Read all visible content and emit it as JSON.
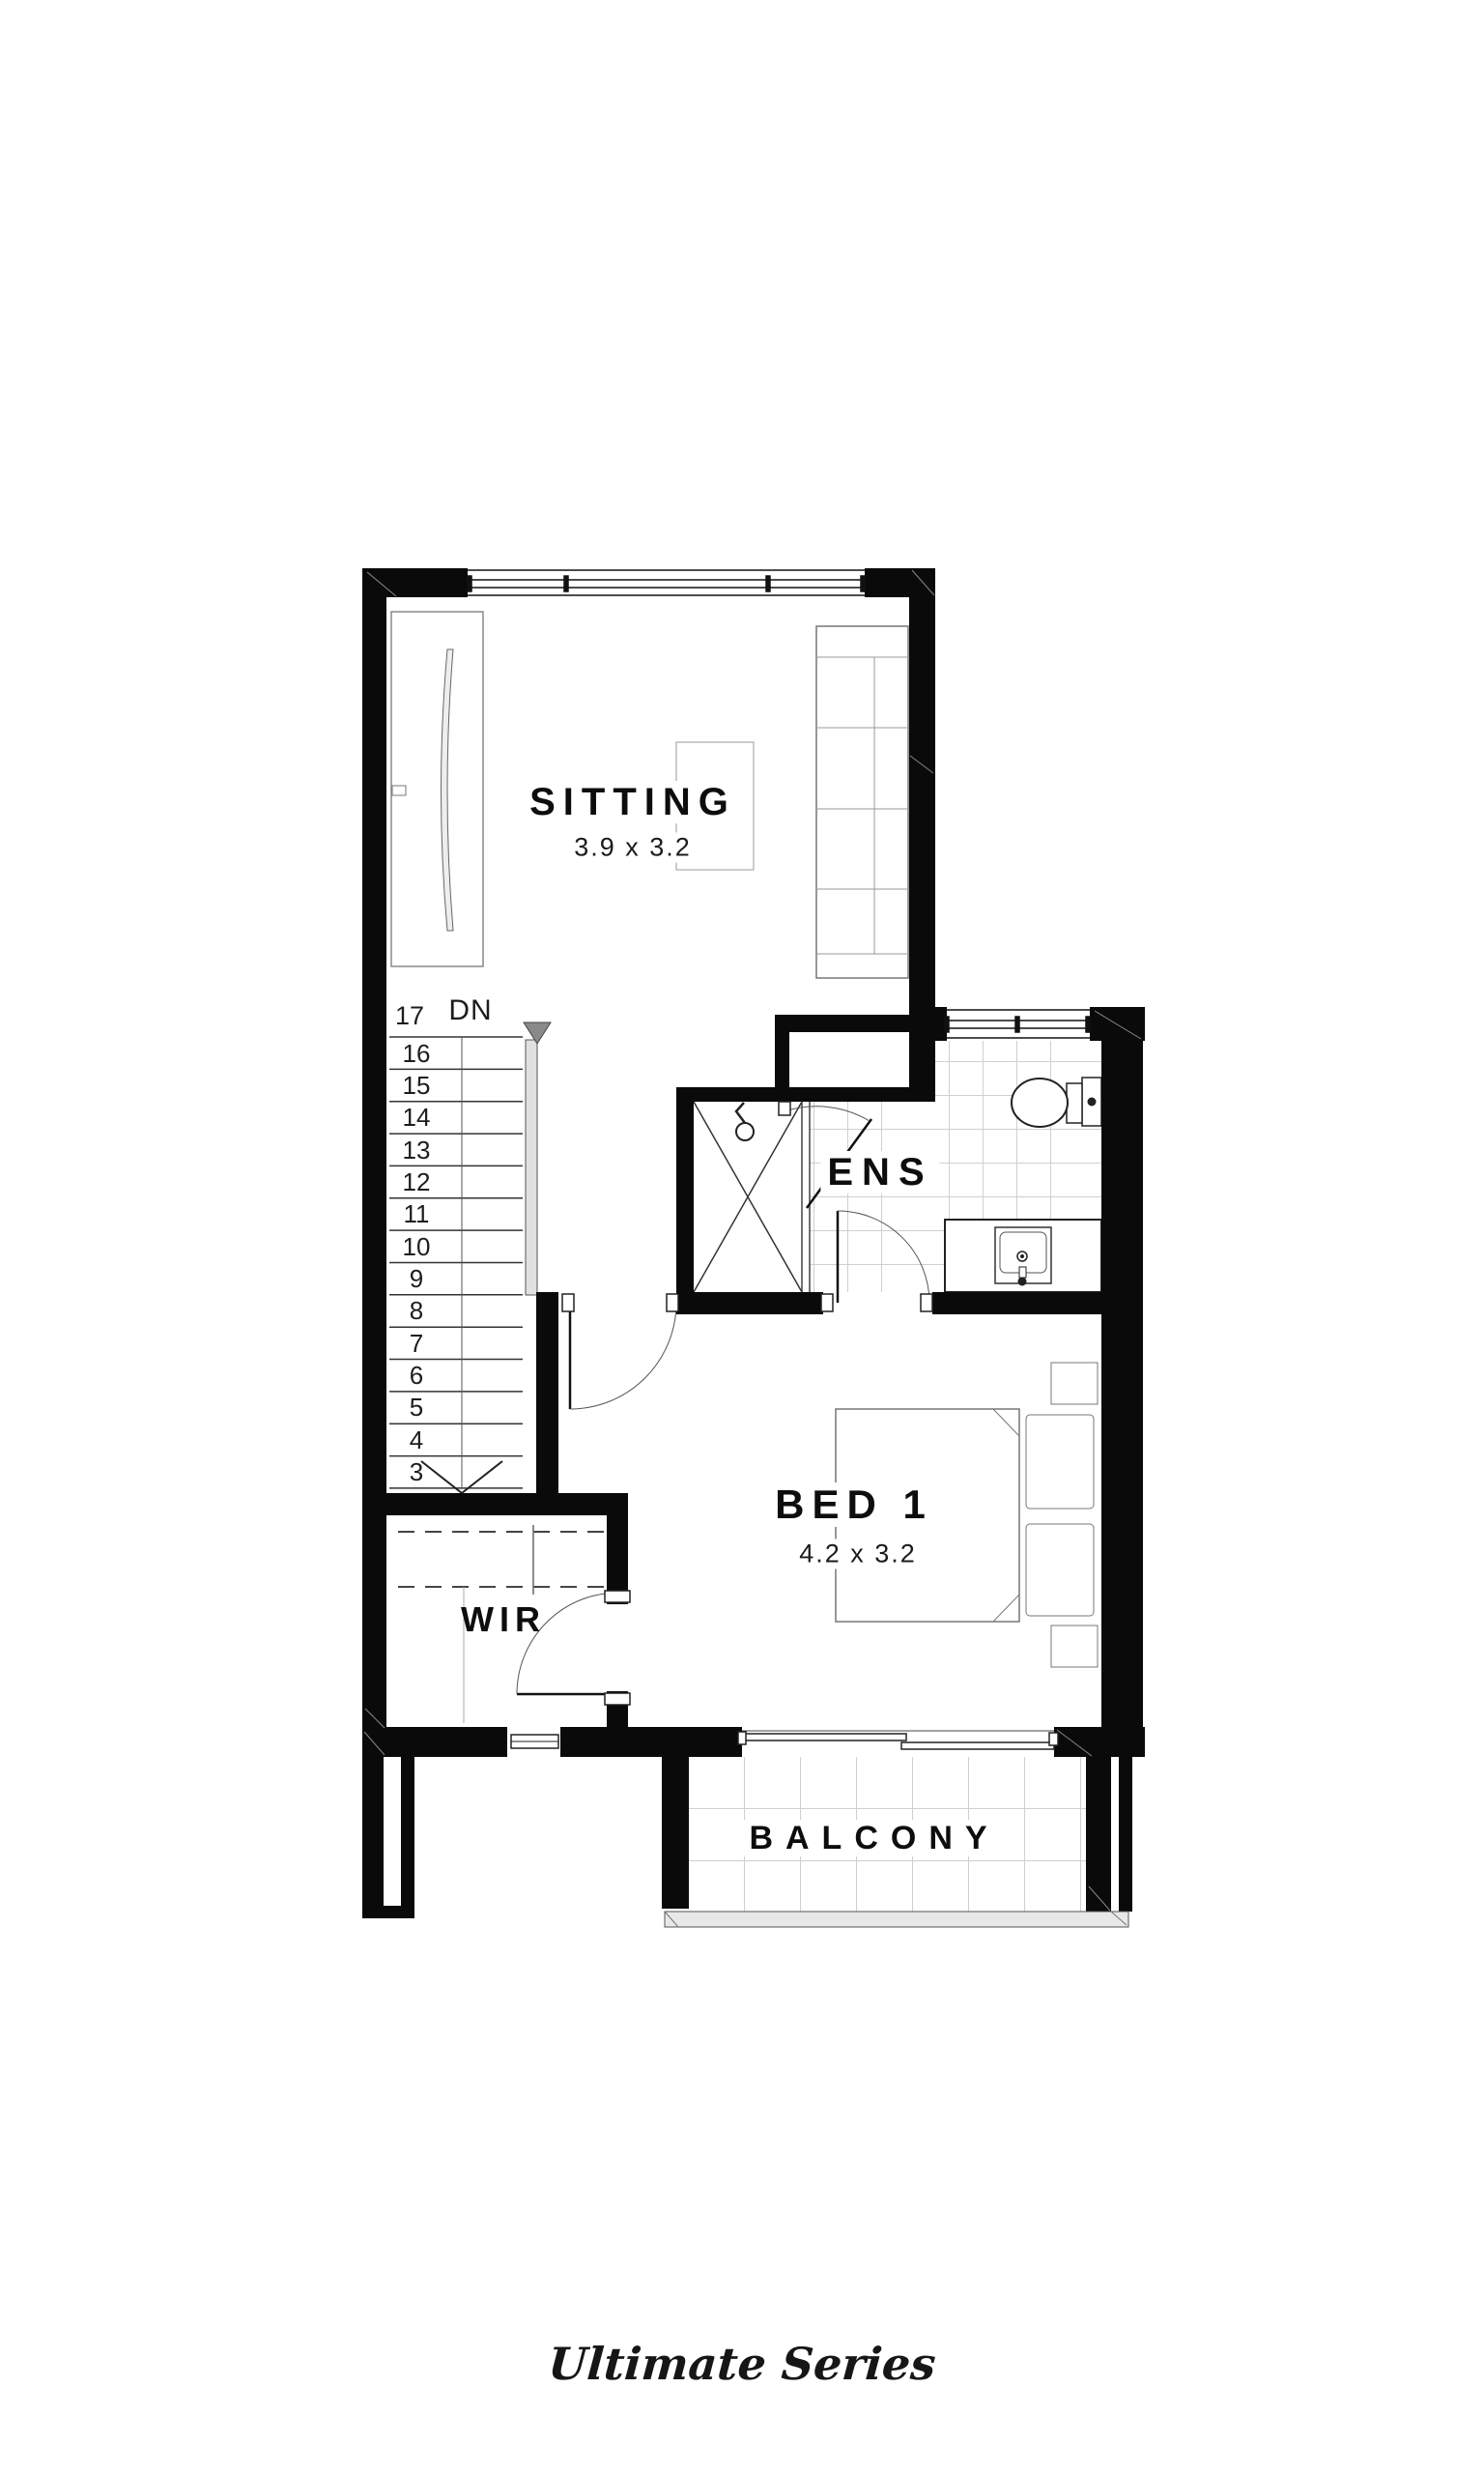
{
  "rooms": {
    "sitting": {
      "name": "SITTING",
      "dims": "3.9 x 3.2"
    },
    "ens": {
      "name": "ENS"
    },
    "bed1": {
      "name": "BED 1",
      "dims": "4.2 x 3.2"
    },
    "wir": {
      "name": "WIR"
    },
    "balcony": {
      "name": "BALCONY"
    }
  },
  "stairs": {
    "top_step": "17",
    "direction_label": "DN",
    "steps": [
      "16",
      "15",
      "14",
      "13",
      "12",
      "11",
      "10",
      "9",
      "8",
      "7",
      "6",
      "5",
      "4",
      "3"
    ]
  },
  "footer": {
    "brand": "Ultimate Series"
  },
  "colors": {
    "wall": "#0a0a0a",
    "line": "#444444",
    "tile": "#cccccc",
    "text": "#111111"
  }
}
